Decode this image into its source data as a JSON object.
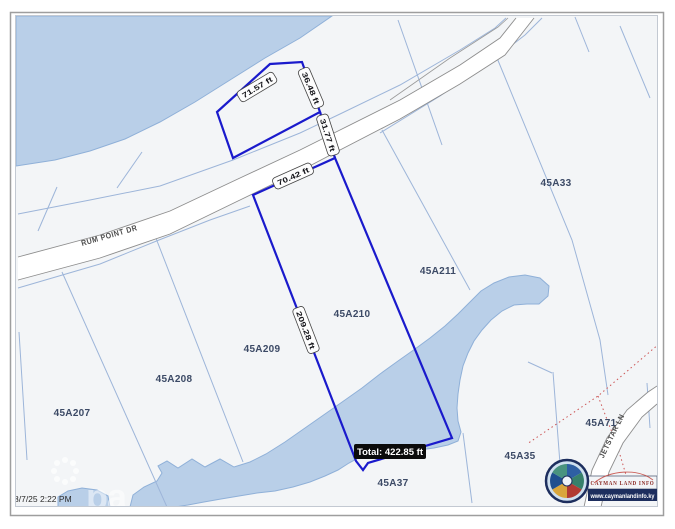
{
  "map": {
    "timestamp": "8/7/25 2:22 PM",
    "watermark_text": "pa",
    "roads": [
      {
        "name": "RUM POINT DR"
      },
      {
        "name": "JETSTAR LN"
      }
    ],
    "parcels": [
      {
        "id": "45A33"
      },
      {
        "id": "45A211"
      },
      {
        "id": "45A210"
      },
      {
        "id": "45A209"
      },
      {
        "id": "45A208"
      },
      {
        "id": "45A207"
      },
      {
        "id": "45A71"
      },
      {
        "id": "45A35"
      },
      {
        "id": "45A37"
      }
    ],
    "measurement": {
      "segments": [
        {
          "length": "71.57 ft"
        },
        {
          "length": "36.48 ft"
        },
        {
          "length": "31.77 ft"
        },
        {
          "length": "70.42 ft"
        },
        {
          "length": "209.28 ft"
        }
      ],
      "total": "Total: 422.85 ft"
    },
    "branding": {
      "org": "CAYMAN LAND INFO",
      "url": "www.caymanlandinfo.ky"
    }
  },
  "colors": {
    "land": "#f3f5f7",
    "water": "#b9cfe8",
    "water_edge": "#8fb0d8",
    "parcel_line": "#9db5d9",
    "road_casing": "#8d8d8d",
    "pending_boundary": "#cc5555",
    "measure_line": "#1a1acc",
    "tooltip_bg": "#0b0b0b",
    "brand_navy": "#1d2e5e"
  }
}
